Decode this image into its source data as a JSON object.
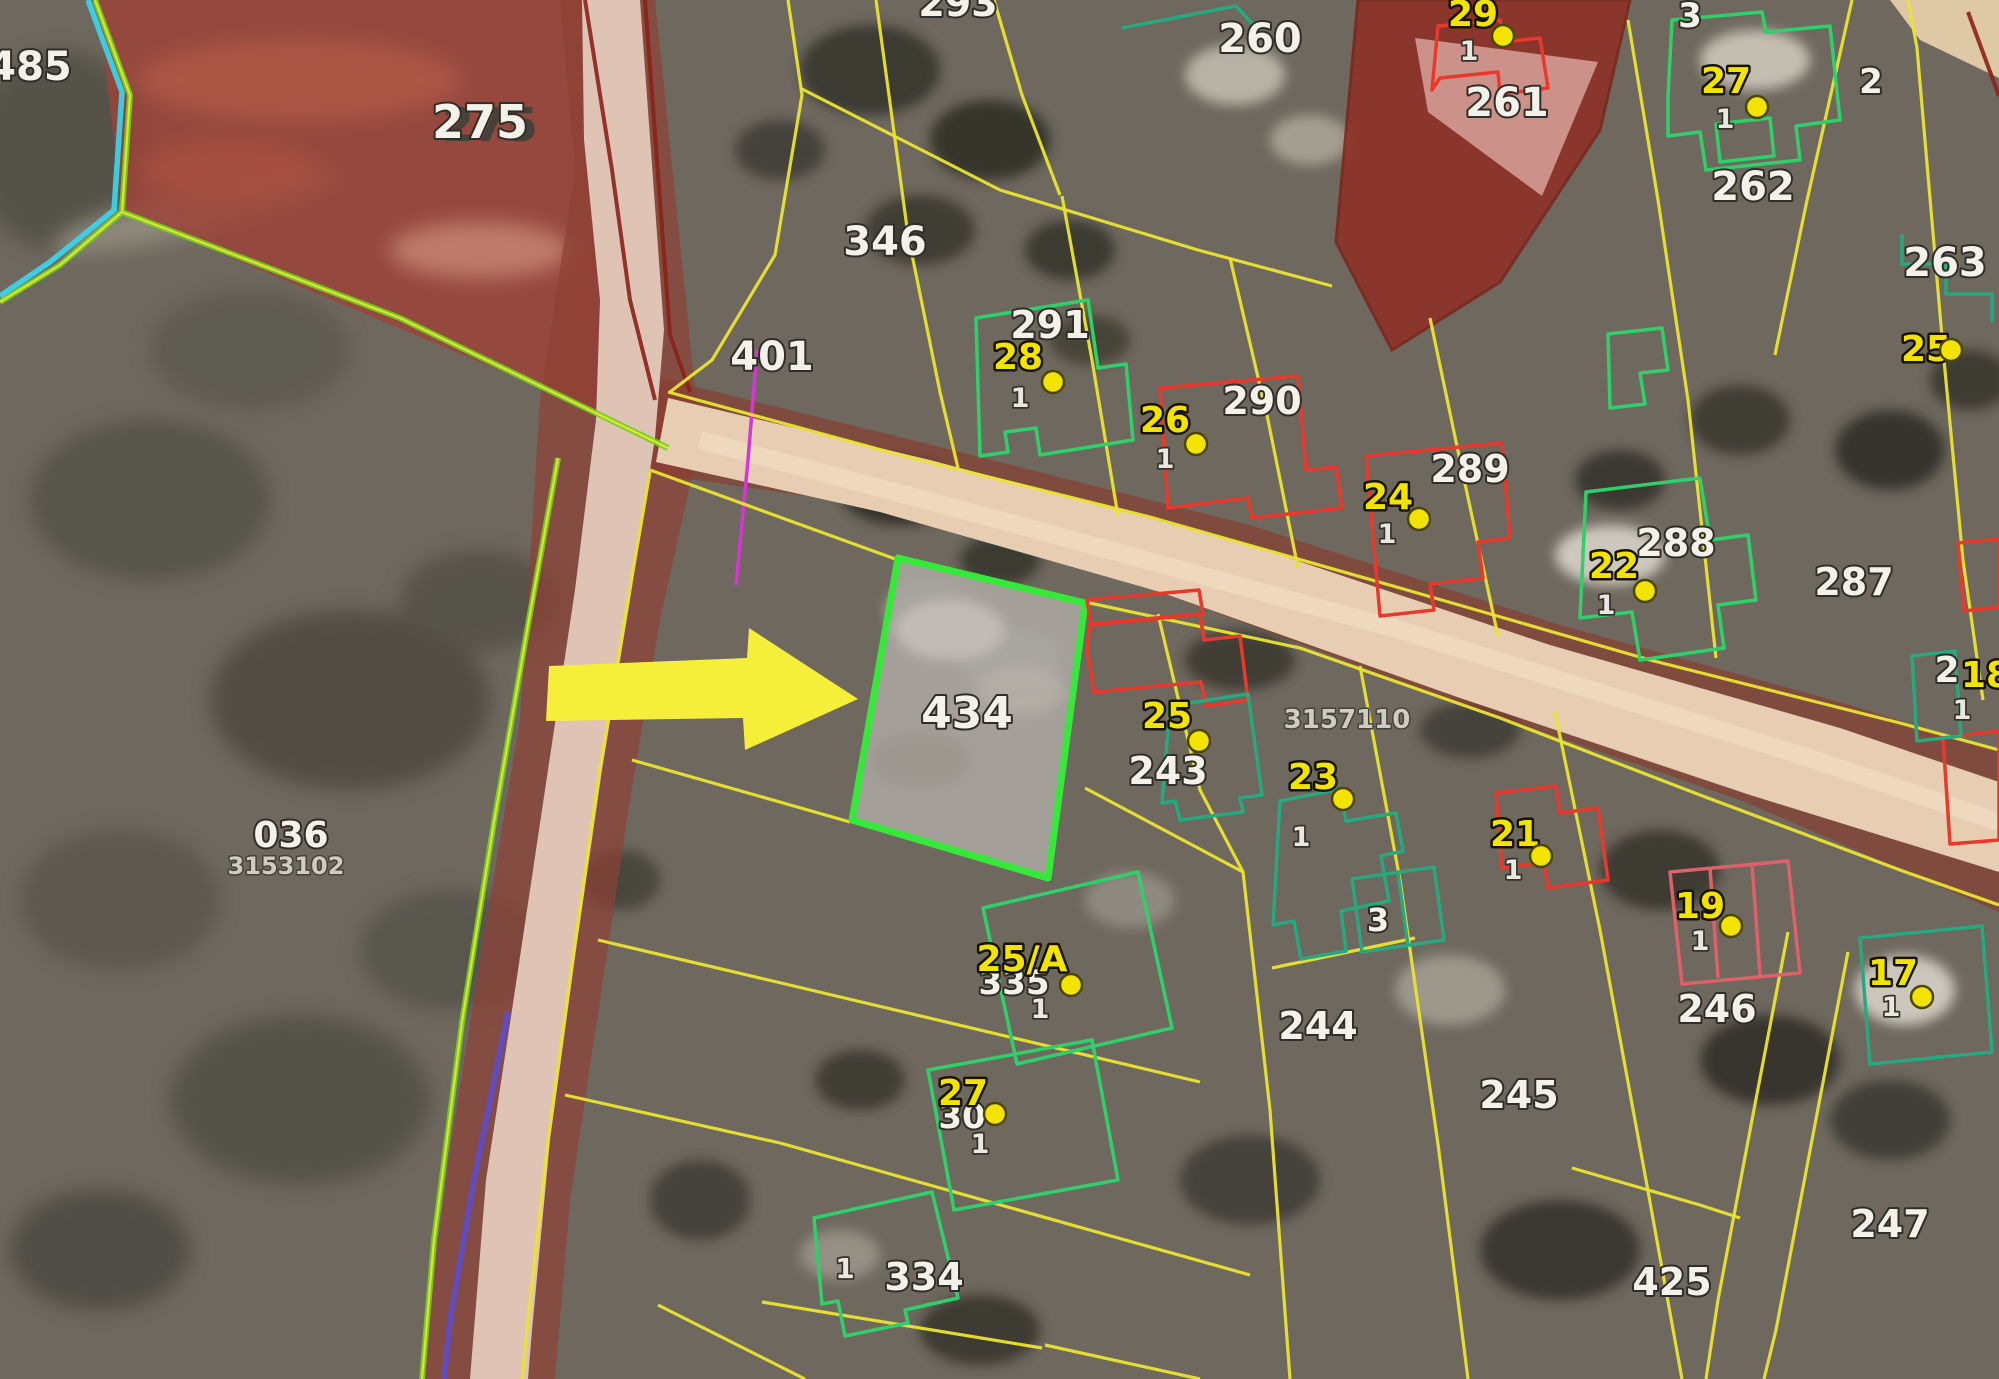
{
  "view": {
    "kind": "cadastral-aerial-map",
    "highlighted_parcel": "434"
  },
  "colors": {
    "parcel-yellow": "#e9e432",
    "boundary-green": "#6ed321",
    "boundary-cyan": "#3ad2ea",
    "boundary-magenta": "#d636d6",
    "boundary-purple": "#5d4bd0",
    "boundary-darkred": "#8a2218",
    "building-green": "#2fd06a",
    "building-teal": "#27a87e",
    "building-red": "#e8392c",
    "building-pink": "#e0606a",
    "parcel-highlight-green": "#35e83a",
    "address-yellow": "#f2e400",
    "dot-yellow": "#f2e400",
    "label-white": "#f3f1ea",
    "label-gray": "#cfccc2",
    "road-tan": "#e7ceb2",
    "road-pink": "#dfc3b4",
    "field-red": "#9c4438",
    "arrow-yellow": "#f6ef3a"
  },
  "map": {
    "parcel_labels": [
      {
        "text": "485",
        "x": 30,
        "y": 80,
        "size": 40
      },
      {
        "text": "275",
        "x": 480,
        "y": 138,
        "size": 46,
        "shadow": true
      },
      {
        "text": "293",
        "x": 958,
        "y": 16,
        "size": 38
      },
      {
        "text": "346",
        "x": 885,
        "y": 255,
        "size": 40
      },
      {
        "text": "401",
        "x": 772,
        "y": 370,
        "size": 40
      },
      {
        "text": "260",
        "x": 1260,
        "y": 52,
        "size": 40
      },
      {
        "text": "261",
        "x": 1507,
        "y": 116,
        "size": 40
      },
      {
        "text": "262",
        "x": 1753,
        "y": 200,
        "size": 40
      },
      {
        "text": "263",
        "x": 1945,
        "y": 276,
        "size": 40
      },
      {
        "text": "291",
        "x": 1050,
        "y": 338,
        "size": 38
      },
      {
        "text": "290",
        "x": 1262,
        "y": 414,
        "size": 38
      },
      {
        "text": "289",
        "x": 1470,
        "y": 482,
        "size": 38
      },
      {
        "text": "288",
        "x": 1676,
        "y": 556,
        "size": 38
      },
      {
        "text": "287",
        "x": 1854,
        "y": 595,
        "size": 38
      },
      {
        "text": "434",
        "x": 967,
        "y": 728,
        "size": 44
      },
      {
        "text": "243",
        "x": 1168,
        "y": 784,
        "size": 38
      },
      {
        "text": "2",
        "x": 1947,
        "y": 682,
        "size": 36
      },
      {
        "text": "335",
        "x": 1014,
        "y": 994,
        "size": 34
      },
      {
        "text": "30",
        "x": 962,
        "y": 1128,
        "size": 34
      },
      {
        "text": "334",
        "x": 924,
        "y": 1290,
        "size": 38
      },
      {
        "text": "244",
        "x": 1318,
        "y": 1039,
        "size": 38
      },
      {
        "text": "245",
        "x": 1519,
        "y": 1108,
        "size": 38
      },
      {
        "text": "246",
        "x": 1717,
        "y": 1022,
        "size": 38
      },
      {
        "text": "247",
        "x": 1890,
        "y": 1237,
        "size": 38
      },
      {
        "text": "425",
        "x": 1672,
        "y": 1295,
        "size": 38
      },
      {
        "text": "036",
        "x": 291,
        "y": 847,
        "size": 36
      },
      {
        "text": "2",
        "x": 1871,
        "y": 93,
        "size": 34
      },
      {
        "text": "3",
        "x": 1690,
        "y": 27,
        "size": 34
      },
      {
        "text": "3",
        "x": 1378,
        "y": 931,
        "size": 32
      }
    ],
    "small_labels": [
      {
        "text": "3153102",
        "x": 286,
        "y": 874,
        "size": 24
      },
      {
        "text": "3157110",
        "x": 1347,
        "y": 728,
        "size": 26
      }
    ],
    "addresses": [
      {
        "number": "29",
        "x": 1473,
        "y": 26,
        "dot": [
          1503,
          36
        ],
        "unit": {
          "text": "1",
          "x": 1469,
          "y": 60
        }
      },
      {
        "number": "27",
        "x": 1726,
        "y": 93,
        "dot": [
          1757,
          107
        ],
        "unit": {
          "text": "1",
          "x": 1725,
          "y": 128
        }
      },
      {
        "number": "25",
        "x": 1926,
        "y": 361,
        "dot": [
          1951,
          350
        ]
      },
      {
        "number": "28",
        "x": 1018,
        "y": 369,
        "dot": [
          1053,
          382
        ],
        "unit": {
          "text": "1",
          "x": 1020,
          "y": 407
        }
      },
      {
        "number": "26",
        "x": 1165,
        "y": 432,
        "dot": [
          1196,
          444
        ],
        "unit": {
          "text": "1",
          "x": 1165,
          "y": 468
        }
      },
      {
        "number": "24",
        "x": 1388,
        "y": 509,
        "dot": [
          1419,
          519
        ],
        "unit": {
          "text": "1",
          "x": 1387,
          "y": 543
        }
      },
      {
        "number": "22",
        "x": 1614,
        "y": 578,
        "dot": [
          1645,
          591
        ],
        "unit": {
          "text": "1",
          "x": 1606,
          "y": 614
        }
      },
      {
        "number": "25",
        "x": 1167,
        "y": 728,
        "dot": [
          1199,
          741
        ]
      },
      {
        "number": "23",
        "x": 1313,
        "y": 789,
        "dot": [
          1343,
          799
        ],
        "unit": {
          "text": "1",
          "x": 1301,
          "y": 846
        }
      },
      {
        "number": "21",
        "x": 1515,
        "y": 846,
        "dot": [
          1541,
          856
        ],
        "unit": {
          "text": "1",
          "x": 1513,
          "y": 879
        }
      },
      {
        "number": "25/A",
        "x": 1022,
        "y": 971,
        "dot": [
          1071,
          985
        ],
        "unit": {
          "text": "1",
          "x": 1040,
          "y": 1018
        }
      },
      {
        "number": "19",
        "x": 1700,
        "y": 918,
        "dot": [
          1731,
          926
        ],
        "unit": {
          "text": "1",
          "x": 1700,
          "y": 950
        }
      },
      {
        "number": "17",
        "x": 1893,
        "y": 985,
        "dot": [
          1922,
          997
        ],
        "unit": {
          "text": "1",
          "x": 1891,
          "y": 1016
        }
      },
      {
        "number": "27",
        "x": 963,
        "y": 1105,
        "dot": [
          995,
          1114
        ],
        "unit": {
          "text": "1",
          "x": 980,
          "y": 1153
        }
      },
      {
        "number": "18",
        "x": 1986,
        "y": 687,
        "unit": {
          "text": "1",
          "x": 1962,
          "y": 719
        }
      }
    ],
    "extra_units": [
      {
        "text": "1",
        "x": 845,
        "y": 1278,
        "size": 28
      }
    ]
  }
}
